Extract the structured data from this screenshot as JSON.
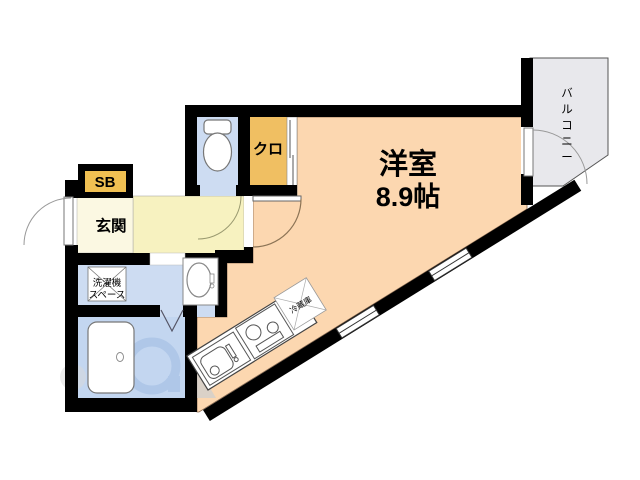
{
  "plan": {
    "type": "apartment-floor-plan",
    "rooms": {
      "main": {
        "name": "洋室",
        "size": "8.9帖"
      },
      "balcony": {
        "label": "バルコニー"
      },
      "closet": {
        "label": "クロ"
      },
      "shoebox": {
        "label": "SB"
      },
      "entrance": {
        "label": "玄関"
      },
      "washer": {
        "lines": [
          "洗濯機",
          "スペース"
        ]
      },
      "fridge": {
        "label": "冷蔵庫"
      }
    },
    "colors": {
      "wall": "#000000",
      "main_room": "#fcd7b0",
      "hallway": "#f7f2c0",
      "entrance": "#fbf8e2",
      "closet": "#f0bf62",
      "shoebox": "#f0c052",
      "water_blue": "#cddcf2",
      "bath_blue": "#c3d6f0",
      "balcony_gray": "#e8e8ec",
      "fixture_stroke": "#777777",
      "door_arc": "#8b7355"
    }
  }
}
